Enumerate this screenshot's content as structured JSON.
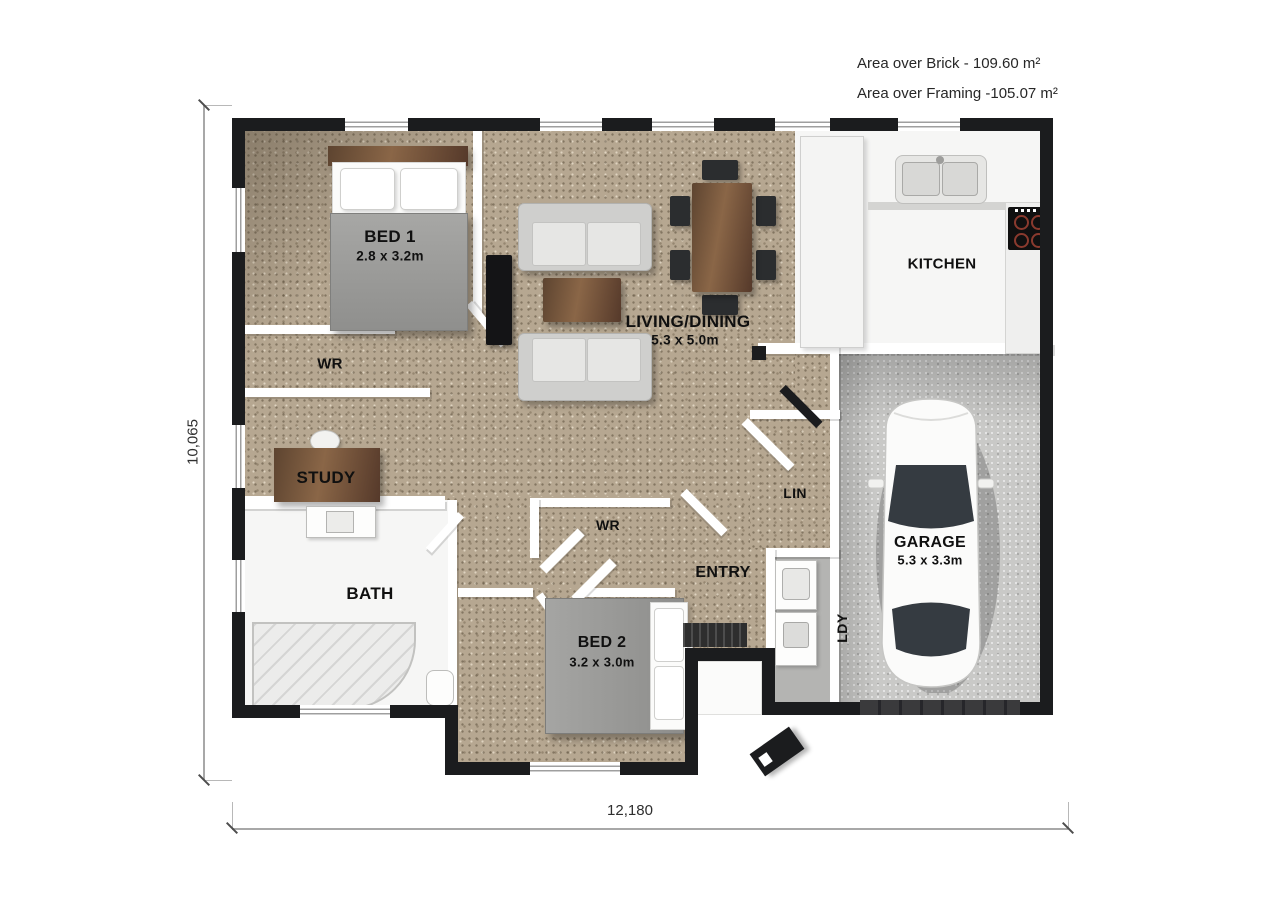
{
  "annotations": {
    "area_over_brick": "Area over Brick - 109.60 m²",
    "area_over_framing": "Area over Framing -105.07 m²"
  },
  "dimensions": {
    "overall_width": "12,180",
    "overall_height": "10,065"
  },
  "rooms": {
    "bed1": {
      "label": "BED 1",
      "size": "2.8 x 3.2m"
    },
    "wr1": {
      "label": "WR"
    },
    "study": {
      "label": "STUDY"
    },
    "bath": {
      "label": "BATH"
    },
    "living": {
      "label": "LIVING/DINING",
      "size": "5.3 x 5.0m"
    },
    "kitchen": {
      "label": "KITCHEN"
    },
    "wr2": {
      "label": "WR"
    },
    "entry": {
      "label": "ENTRY"
    },
    "lin": {
      "label": "LIN"
    },
    "bed2": {
      "label": "BED 2",
      "size": "3.2 x 3.0m"
    },
    "ldy": {
      "label": "LDY"
    },
    "garage": {
      "label": "GARAGE",
      "size": "5.3 x 3.3m"
    }
  },
  "colors": {
    "carpet": "#b6a791",
    "exterior_wall": "#1b1c1e",
    "garage_floor": "#c9c9c7",
    "label_text": "#101010",
    "dimension_text": "#2f2f2f"
  }
}
